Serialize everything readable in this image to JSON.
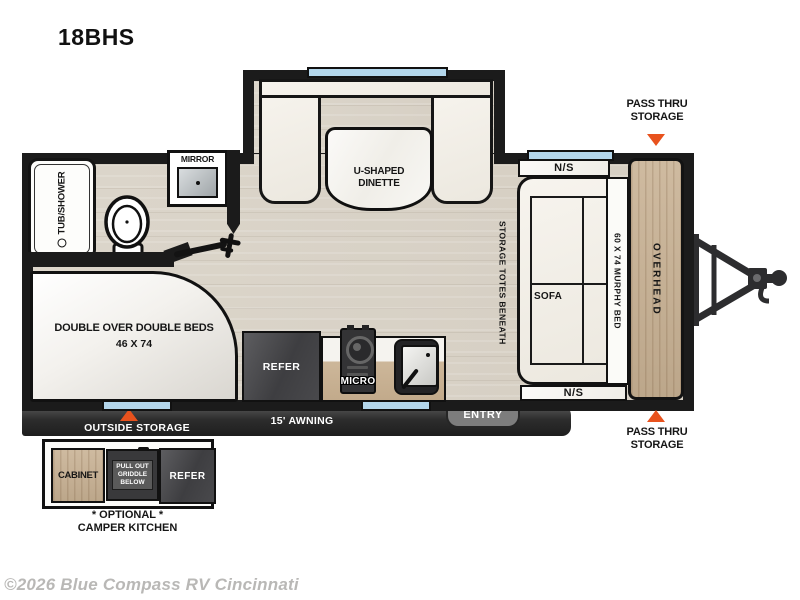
{
  "page": {
    "title": "18BHS",
    "copyright": "©2026 Blue Compass RV Cincinnati"
  },
  "colors": {
    "accent_triangle": "#e8521d",
    "wall": "#1b1b1b",
    "window": "#b3d6eb",
    "cabinet_wood": "#c8b193",
    "floor": "#dad4c9"
  },
  "floorplan": {
    "bathroom": {
      "tub_shower": "TUB/SHOWER",
      "mirror": "MIRROR"
    },
    "dinette": {
      "label": "U-SHAPED DINETTE"
    },
    "living": {
      "ns_top": "N/S",
      "ns_bottom": "N/S",
      "sofa": "SOFA",
      "murphy_bed": "60 X 74 MURPHY BED",
      "overhead": "OVERHEAD",
      "storage_totes": "STORAGE TOTES BENEATH"
    },
    "bedroom": {
      "beds": "DOUBLE OVER DOUBLE BEDS",
      "beds_size": "46 X 74"
    },
    "kitchen": {
      "refer": "REFER",
      "micro": "MICRO"
    },
    "exterior": {
      "pass_thru_top": "PASS THRU STORAGE",
      "pass_thru_bottom": "PASS THRU STORAGE",
      "outside_storage": "OUTSIDE STORAGE",
      "awning": "15' AWNING",
      "entry": "ENTRY"
    },
    "camper_kitchen": {
      "cabinet": "CABINET",
      "griddle": "PULL OUT GRIDDLE BELOW",
      "refer": "REFER",
      "caption_1": "* OPTIONAL *",
      "caption_2": "CAMPER KITCHEN"
    }
  }
}
